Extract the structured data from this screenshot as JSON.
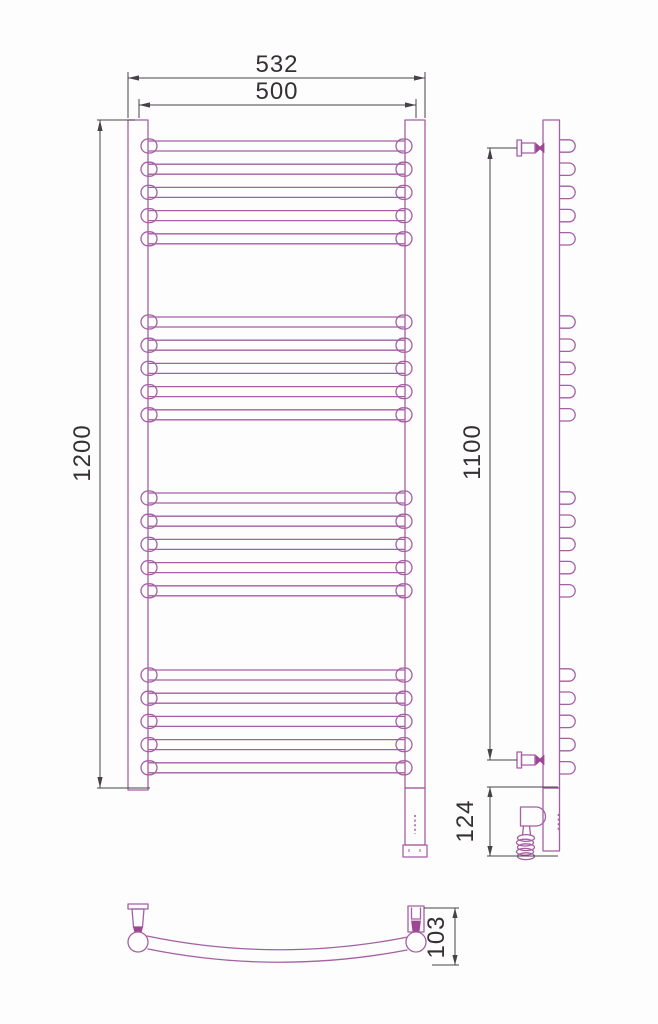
{
  "drawing": {
    "title": "towel-rail-technical-drawing",
    "dimensions": {
      "outer_width": "532",
      "inner_width": "500",
      "total_height": "1200",
      "mounting_height": "1100",
      "heater_section_height": "124",
      "depth": "103"
    },
    "structure": {
      "bar_groups": 4,
      "bars_per_group": 5
    },
    "colors": {
      "outline": "#a55fa3",
      "knob": "#9c4694",
      "dimension_lines": "#474247",
      "text": "#343034",
      "background": "#fdfdfd"
    }
  }
}
